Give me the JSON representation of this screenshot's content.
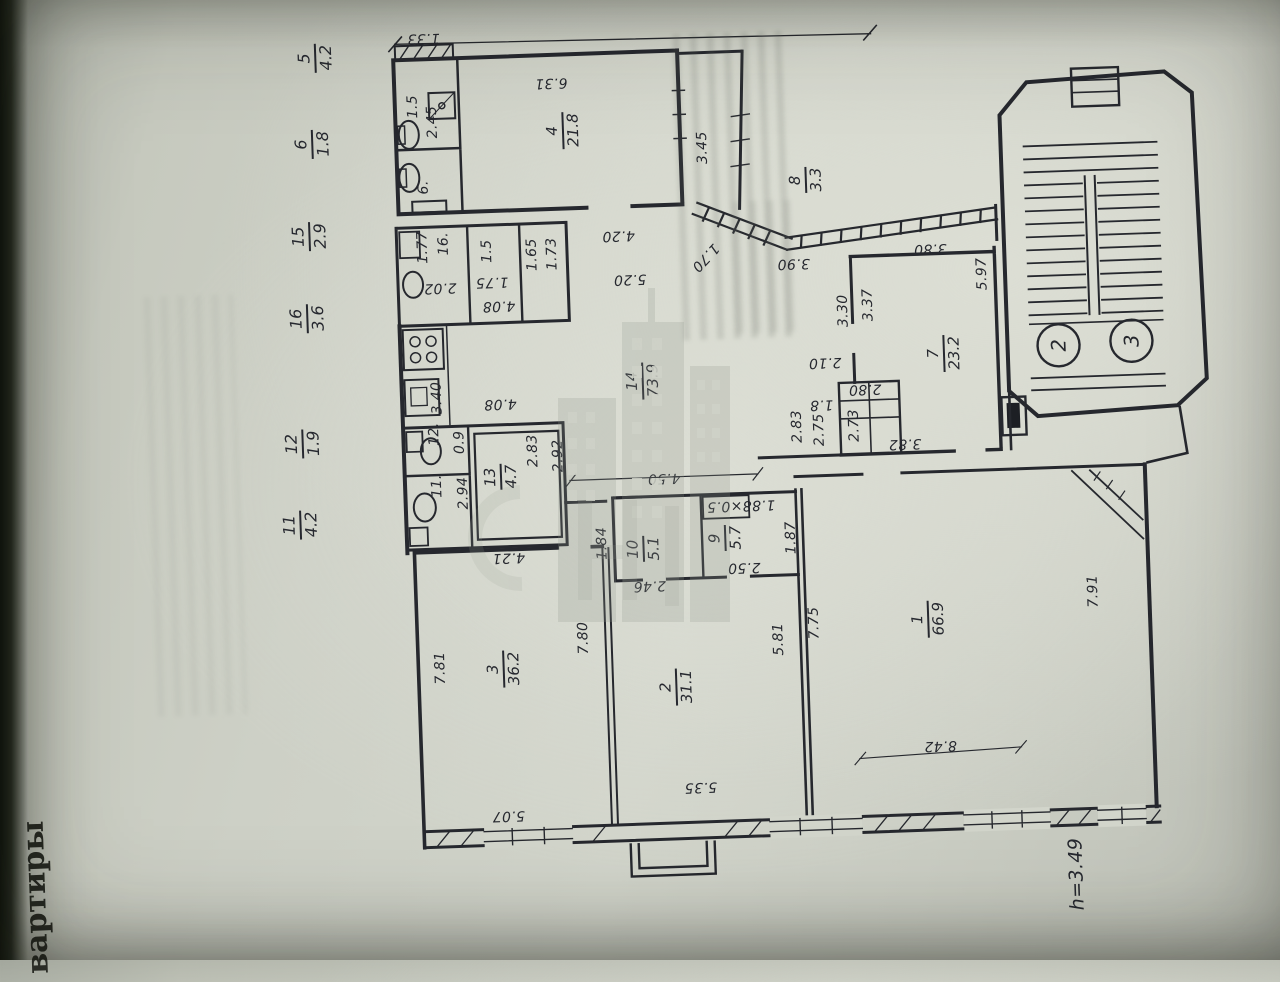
{
  "page": {
    "side_text": "вартиры",
    "height_note": "h=3.49"
  },
  "margin_fractions": [
    {
      "num": "5",
      "den": "4.2"
    },
    {
      "num": "6",
      "den": "1.8"
    },
    {
      "num": "15",
      "den": "2.9"
    },
    {
      "num": "16",
      "den": "3.6"
    },
    {
      "num": "12",
      "den": "1.9"
    },
    {
      "num": "11",
      "den": "4.2"
    }
  ],
  "rooms": {
    "r1": {
      "num": "1",
      "area": "66.9"
    },
    "r2": {
      "num": "2",
      "area": "31.1"
    },
    "r3": {
      "num": "3",
      "area": "36.2"
    },
    "r4": {
      "num": "4",
      "area": "21.8"
    },
    "r7": {
      "num": "7",
      "area": "23.2"
    },
    "r8": {
      "num": "8",
      "area": "3.3"
    },
    "r9": {
      "num": "9",
      "area": "5.7"
    },
    "r10": {
      "num": "10",
      "area": "5.1"
    },
    "r13": {
      "num": "13",
      "area": "4.7"
    },
    "r14": {
      "num": "14",
      "area": "73.9"
    }
  },
  "plain_numbers": {
    "p6": "6.",
    "p11": "11.",
    "p12": "12.",
    "p16": "16."
  },
  "stairs": {
    "circle_a": "2",
    "circle_b": "3"
  },
  "dims": {
    "d_top": "6.31",
    "r4_right": "3.45",
    "bath_w": "1.5",
    "bath_h": "2.45",
    "vent": "1.33",
    "r16_a": "1.77",
    "r16_b": "2.02",
    "r15_a": "1.5",
    "r15_b": "1.75",
    "r15c": "1.65",
    "r15d": "1.73",
    "row_w": "4.08",
    "hall_a": "4.20",
    "hall_b": "5.20",
    "kitchen_h": "3.40",
    "kitchen_w": "4.08",
    "r12_a": "0.9",
    "r11_a": "2.94",
    "r13_a": "2.83",
    "r13_b": "2.92",
    "hall_w": "4.50",
    "diag": "1.70",
    "rail_a": "3.90",
    "rail_b": "3.80",
    "r7_a": "3.30",
    "r7_b": "3.37",
    "r7_r": "5.97",
    "c1": "2.10",
    "c2": "2.80",
    "c3": "1.8",
    "c4": "2.83",
    "c5": "2.75",
    "c6": "2.73",
    "pass": "3.82",
    "r10_a": "1.84",
    "r10_b": "2.46",
    "niche": "1.88×0.5",
    "r9_a": "2.50",
    "r9_b": "1.87",
    "r3_t": "4.21",
    "r3_l": "7.81",
    "r3_b": "5.07",
    "r3_r": "7.80",
    "r2_b": "5.35",
    "r2_r": "5.81",
    "r1_l": "7.75",
    "r1_r": "7.91",
    "r1_b": "8.42"
  },
  "watermark": {
    "icon": "buildings-watermark-icon"
  }
}
